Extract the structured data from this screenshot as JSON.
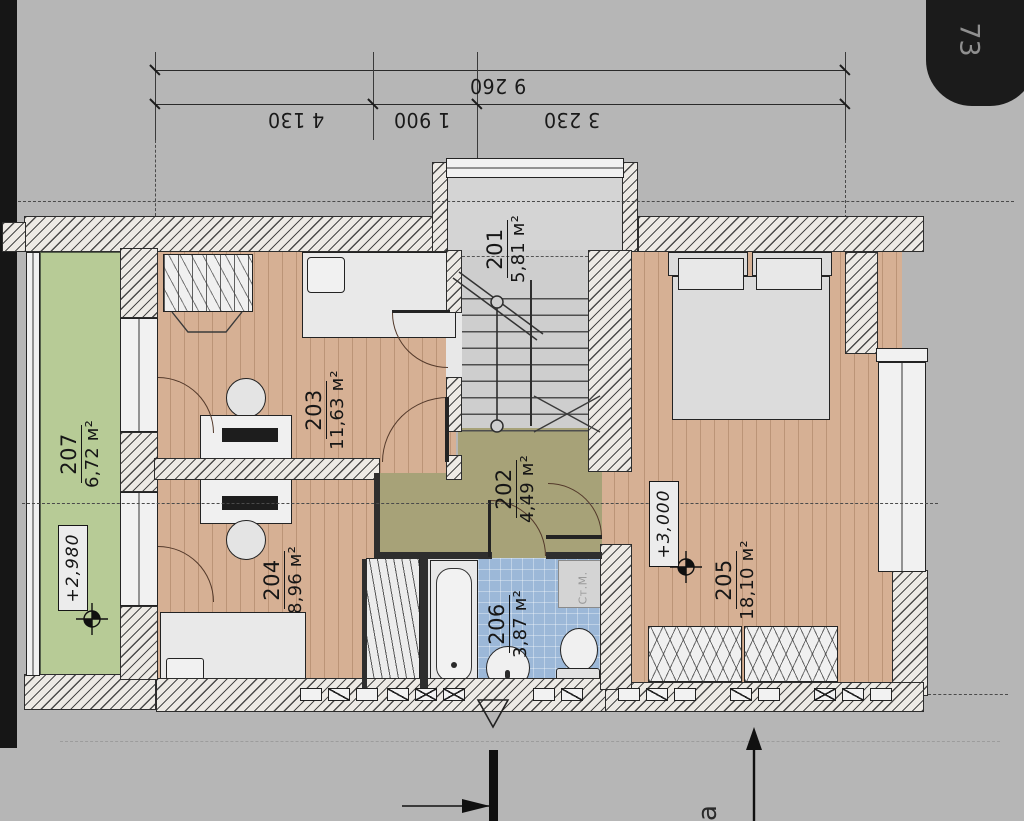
{
  "page": {
    "tab_number": "73"
  },
  "dimensions": {
    "overall": "9 260",
    "segments": [
      "4 130",
      "1 900",
      "3 230"
    ]
  },
  "rooms": [
    {
      "number": "201",
      "area": "5,81 м²"
    },
    {
      "number": "202",
      "area": "4,49 м²"
    },
    {
      "number": "203",
      "area": "11,63 м²"
    },
    {
      "number": "204",
      "area": "8,96 м²"
    },
    {
      "number": "205",
      "area": "18,10 м²"
    },
    {
      "number": "206",
      "area": "3,87 м²"
    },
    {
      "number": "207",
      "area": "6,72 м²"
    }
  ],
  "elevations": [
    {
      "value": "+2,980"
    },
    {
      "value": "+3,000"
    }
  ],
  "labels": {
    "washing_machine": "Ст.М.",
    "partial_text": "а"
  },
  "colors": {
    "paper": "#b6b6b6",
    "wood_floor": "#d6b094",
    "balcony_green": "#b7cb96",
    "corridor_olive": "#a7a278",
    "bath_blue": "#9cb8d8",
    "stair_gray": "#cecece",
    "tab_black": "#1b1b1b"
  }
}
